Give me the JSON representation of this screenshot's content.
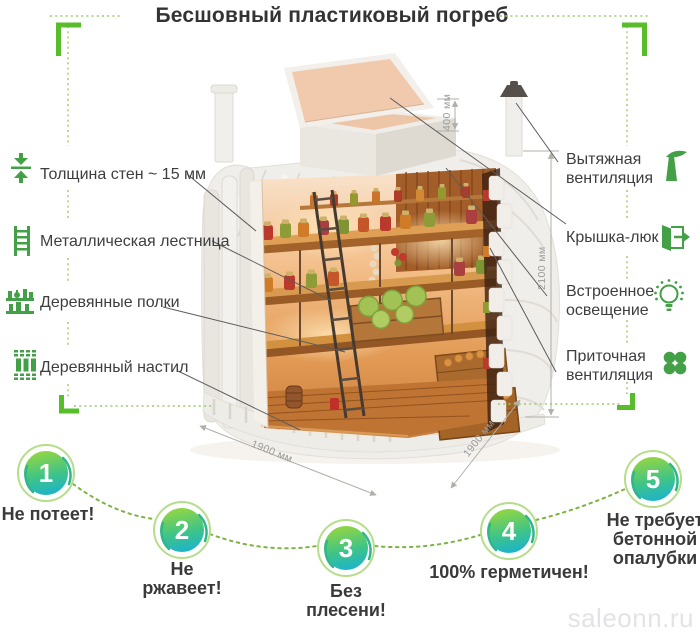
{
  "title": "Бесшовный пластиковый погреб",
  "features_left": [
    {
      "icon": "wall-thickness-icon",
      "label": "Толщина стен ~ 15 мм"
    },
    {
      "icon": "ladder-icon",
      "label": "Металлическая лестница"
    },
    {
      "icon": "shelves-icon",
      "label": "Деревянные полки"
    },
    {
      "icon": "decking-icon",
      "label": "Деревянный настил"
    }
  ],
  "features_right": [
    {
      "icon": "exhaust-vent-icon",
      "label": "Вытяжная вентиляция"
    },
    {
      "icon": "hatch-icon",
      "label": "Крышка-люк"
    },
    {
      "icon": "light-icon",
      "label": "Встроенное освещение"
    },
    {
      "icon": "supply-vent-icon",
      "label": "Приточная вентиляция"
    }
  ],
  "dimensions": {
    "hatch_height": "400 мм",
    "body_height": "2100 мм",
    "width_front": "1900 мм",
    "width_side": "1900 мм"
  },
  "benefits": [
    {
      "number": "1",
      "label": "Не потеет!"
    },
    {
      "number": "2",
      "label": "Не ржавеет!"
    },
    {
      "number": "3",
      "label": "Без плесени!"
    },
    {
      "number": "4",
      "label": "100% герметичен!"
    },
    {
      "number": "5",
      "label": "Не требует бетонной опалубки"
    }
  ],
  "watermark": "saleonn.ru",
  "colors": {
    "icon_green": "#43a047",
    "bracket_green": "#58bd2b",
    "dotted_green": "#9ccb66",
    "badge_ring": "#b5dd8a",
    "badge_gradient_top": "#8bd44a",
    "badge_gradient_bottom": "#1ab2d0",
    "text_dark": "#3c3c3c",
    "dimension_gray": "#9b9b9b"
  }
}
